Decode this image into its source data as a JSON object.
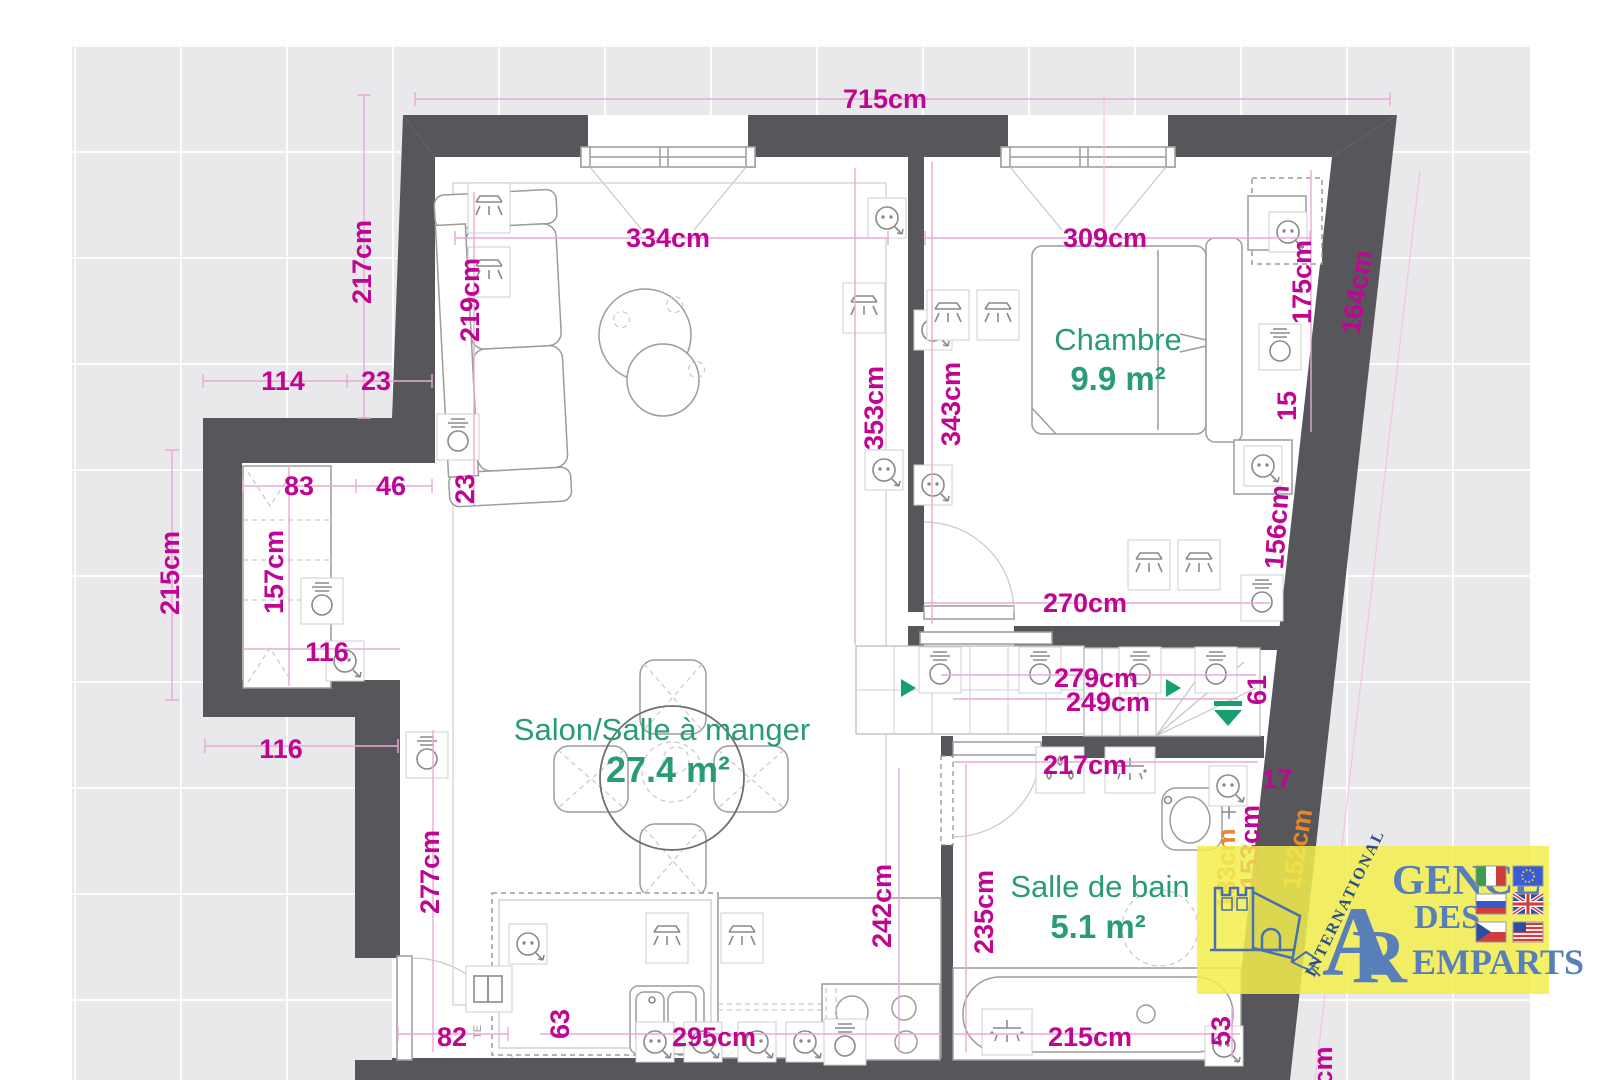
{
  "plan": {
    "rooms": {
      "chambre": {
        "label": "Chambre",
        "area": "9.9 m²"
      },
      "salon": {
        "label": "Salon/Salle à manger",
        "area": "27.4 m²"
      },
      "bath": {
        "label": "Salle de bain",
        "area": "5.1 m²"
      }
    },
    "dimensions": {
      "overall_width": "715cm",
      "salon_width": "334cm",
      "chambre_width": "309cm",
      "left_upper_height": "217cm",
      "sofa_length": "219cm",
      "sofa_offset": "23",
      "step_width": "114",
      "step_wall": "23",
      "alcove_split_a": "83",
      "alcove_split_b": "46",
      "left_mid_height": "215cm",
      "alcove_height": "157cm",
      "alcove_width": "116",
      "step_outer": "116",
      "left_lower_height": "277cm",
      "entry_door": "82",
      "cabinet_width": "63",
      "kitchen_width": "295cm",
      "salon_height_a": "353cm",
      "salon_height_b": "343cm",
      "chambre_bottom": "270cm",
      "bed_side": "175cm",
      "bed_gap": "15",
      "right_wall_upper": "164cm",
      "right_wall_lower": "156cm",
      "hall_length_a": "279cm",
      "hall_length_b": "249cm",
      "stair_width": "61",
      "bath_width": "217cm",
      "bath_corner": "17",
      "bath_height_a": "242cm",
      "bath_height_b": "235cm",
      "bath_diag_a": "183cm",
      "bath_diag_b": "153cm",
      "right_wall_bottom": "152cm",
      "tub_length": "215cm",
      "tub_gap": "53",
      "cutoff_label": "cm"
    },
    "annotations": {
      "te": "TE"
    }
  },
  "logo": {
    "international": "INTERNATIONAL",
    "initial_a": "A",
    "word_gence": "GENCE",
    "initial_r": "R",
    "word_des": "DES",
    "word_emparts": "EMPARTS",
    "flags": [
      "italy-flag",
      "eu-flag",
      "russia-flag",
      "uk-flag",
      "czech-flag",
      "usa-flag"
    ]
  },
  "colors": {
    "wall": "#57565a",
    "dimension": "#bf0692",
    "dimension_alt": "#e8862e",
    "room_label": "#2a9b78",
    "logo_blue": "#587fb8",
    "logo_bg": "#f2ee4e",
    "canvas": "#e9e8ea"
  }
}
